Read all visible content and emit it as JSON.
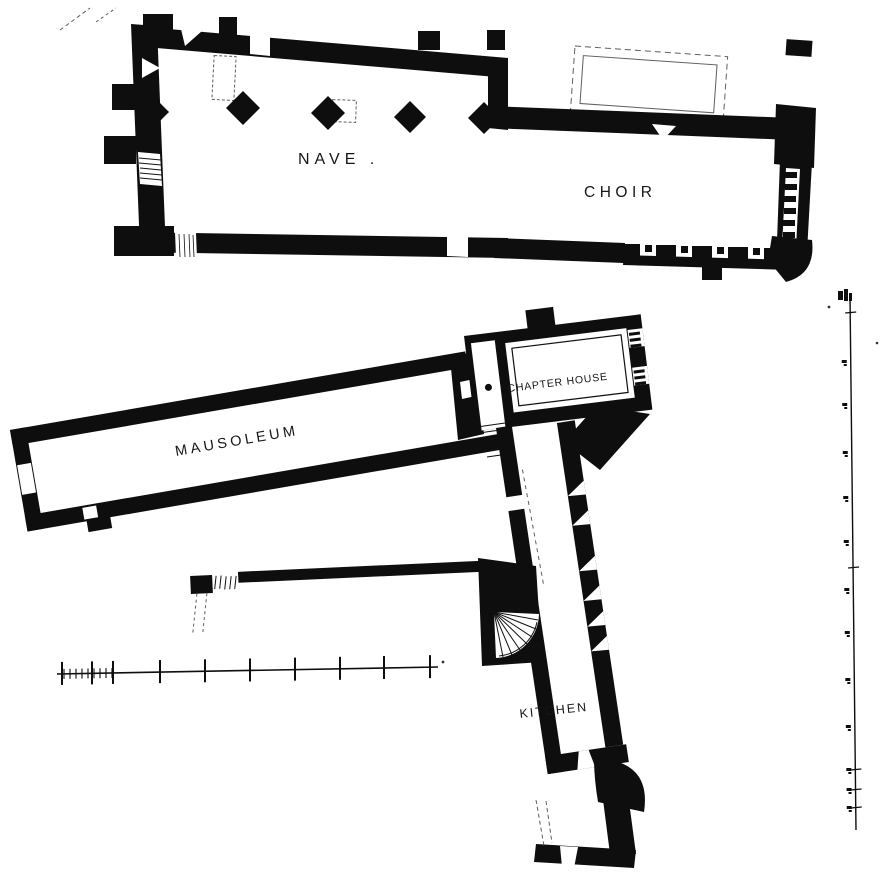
{
  "figure": {
    "kind": "architectural-floor-plan",
    "paper": "#ffffff",
    "ink": "#0e0e0e",
    "faint": "#5f5f5f"
  },
  "labels": {
    "nave": "NAVE .",
    "choir": "CHOIR",
    "mausoleum": "MAUSOLEUM",
    "chapter_house": "CHAPTER HOUSE",
    "kitchen": "KITCHEN"
  },
  "plan": {
    "pillars": [
      {
        "x": 243,
        "y": 108,
        "r": 17
      },
      {
        "x": 328,
        "y": 113,
        "r": 17
      },
      {
        "x": 410,
        "y": 117,
        "r": 16
      },
      {
        "x": 155,
        "y": 112,
        "r": 14
      },
      {
        "x": 484,
        "y": 118,
        "r": 16
      }
    ],
    "scale_bar": {
      "x_start": 57,
      "x_end": 438,
      "y_left": 674,
      "y_right": 667,
      "major_ticks_x": [
        62,
        92,
        113,
        160,
        205,
        250,
        295,
        340,
        384,
        430
      ],
      "minor_ticks": {
        "from": 64,
        "to": 112,
        "step": 6
      }
    },
    "right_ruler": {
      "x_top": 850,
      "y_top": 296,
      "x_bottom": 856,
      "y_bottom": 830,
      "label_marks_y": [
        362,
        405,
        453,
        498,
        542,
        590,
        633,
        680,
        727,
        770,
        790,
        808
      ],
      "cross_ticks_y": [
        313,
        568,
        770,
        790,
        808
      ]
    }
  }
}
